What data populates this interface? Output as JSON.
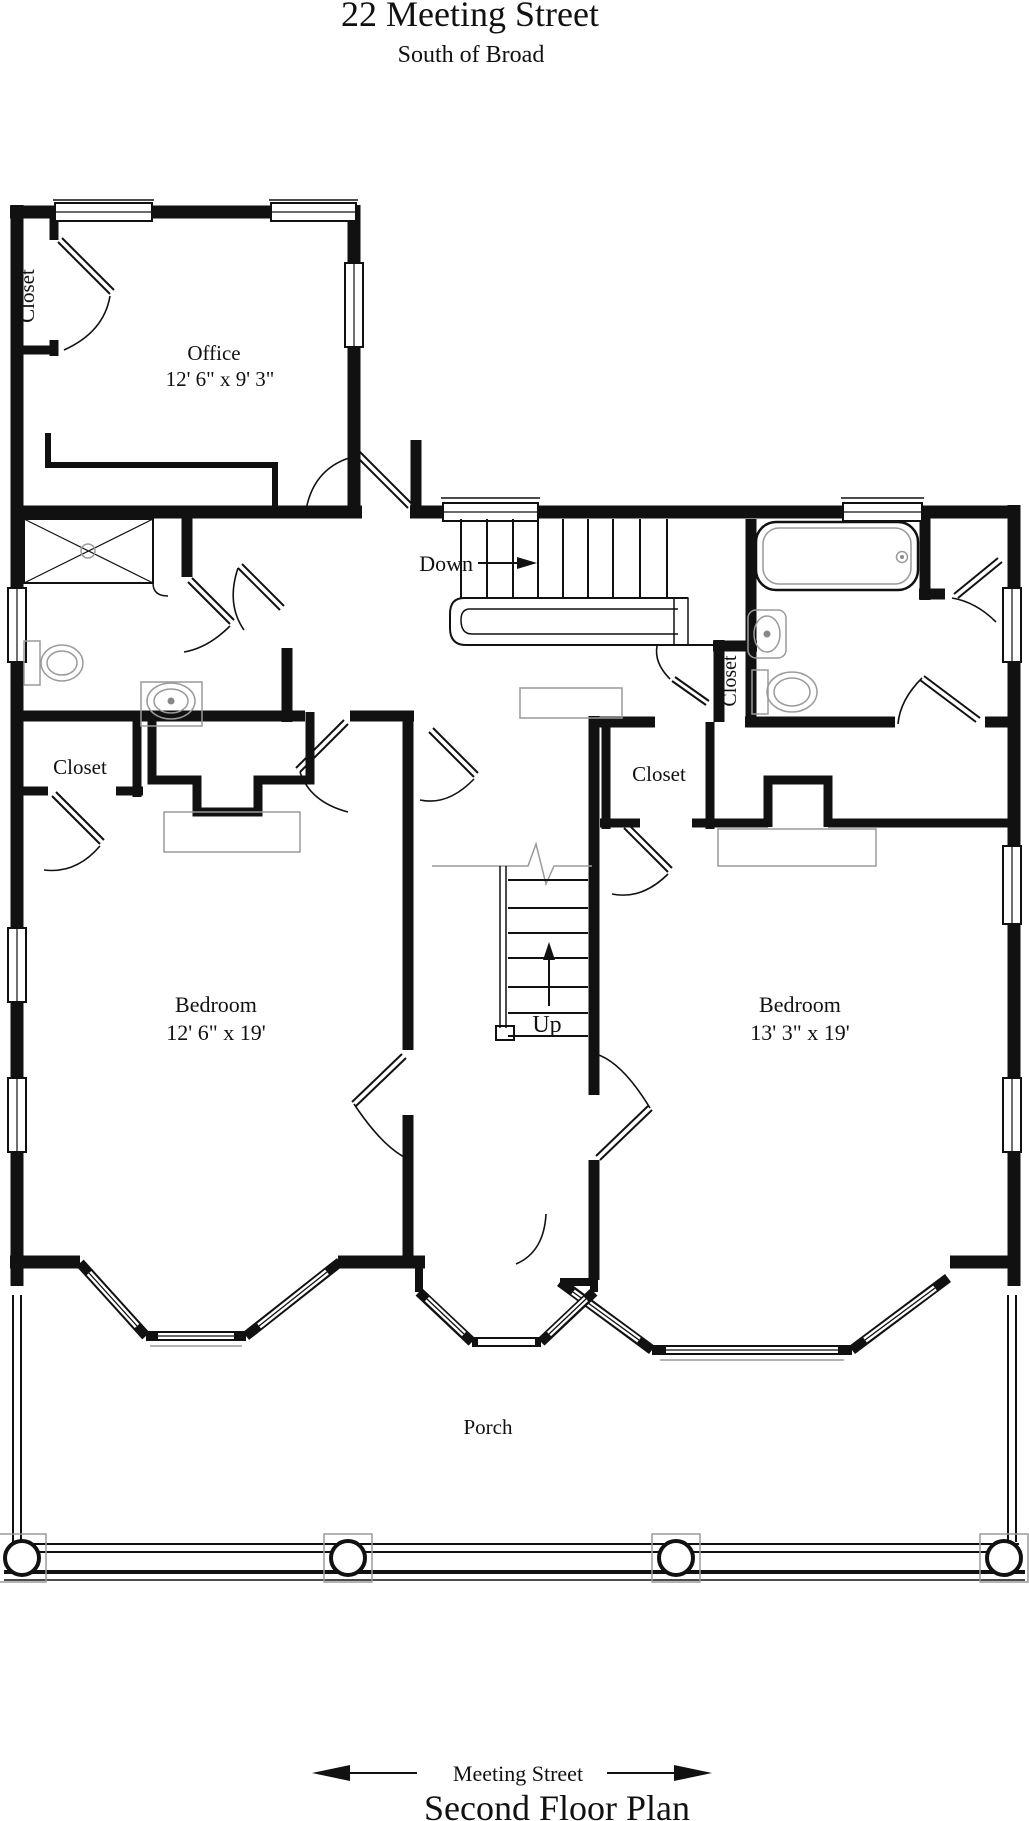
{
  "header": {
    "title": "22 Meeting Street",
    "subtitle": "South of Broad"
  },
  "plan": {
    "office": {
      "label": "Office",
      "dims": "12' 6\" x 9' 3\""
    },
    "office_closet_label": "Closet",
    "hall_closet_label": "Closet",
    "left_bedroom": {
      "label": "Bedroom",
      "dims": "12' 6\" x 19'"
    },
    "right_bedroom": {
      "label": "Bedroom",
      "dims": "13' 3\" x 19'"
    },
    "left_bedroom_closet_label": "Closet",
    "right_bedroom_closet_label": "Closet",
    "porch_label": "Porch",
    "stairs": {
      "down": "Down",
      "up": "Up"
    }
  },
  "footer": {
    "street": "Meeting Street",
    "plan_title": "Second Floor Plan"
  },
  "colors": {
    "ink": "#111111",
    "fixture_gray": "#9a9a9a",
    "background": "#ffffff"
  }
}
